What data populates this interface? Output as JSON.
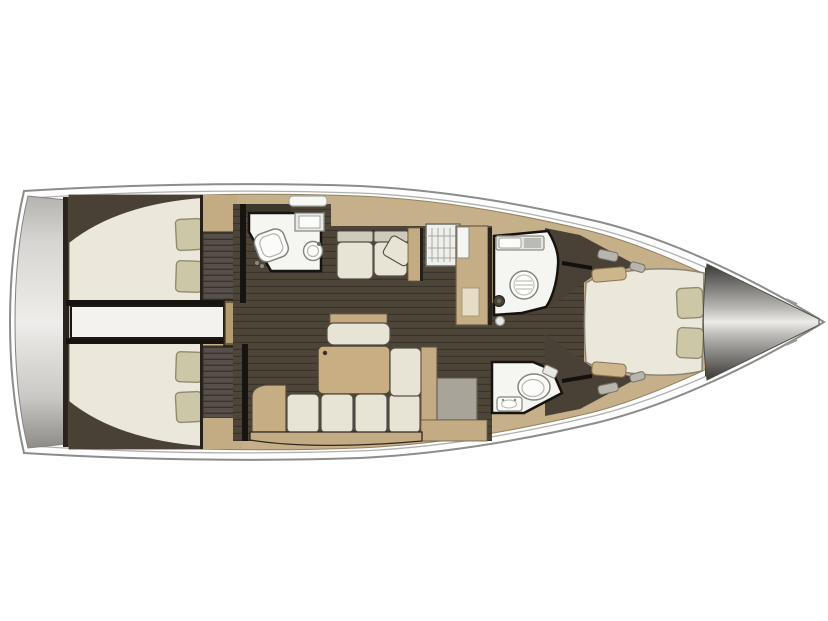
{
  "scene": {
    "type": "yacht-interior-floorplan",
    "orientation": "bow-right",
    "background": "#ffffff"
  },
  "colors": {
    "hull_fill": "#fdfdfd",
    "hull_stroke": "#8c8c8a",
    "inner_line": "#b0b0ae",
    "deck_wood": "#c6b08a",
    "wood_trim": "#c3ac84",
    "wood_dark": "#6b5a40",
    "floor_dark": "#4e4539",
    "floor_line": "#3a332b",
    "wall_dark": "#17130e",
    "divider_dark": "#2a241c",
    "cabin_shadow": "#4a4136",
    "bed_cream": "#ebe8db",
    "cushion_cream": "#e8e4d5",
    "cushion_outline": "#544f48",
    "pillow_khaki": "#cbc7a7",
    "pillow_outline": "#908c6d",
    "backrest_gray": "#cfcabb",
    "room_white": "#f5f5f2",
    "fixture_stroke": "#85857f",
    "counter_gray": "#a9a49a",
    "wardrobe_dark": "#57504a",
    "wardrobe_line": "#39332b",
    "table_wood": "#c9ae83",
    "ladder_wood": "#c9b284",
    "ladder_base": "#6e5b3f",
    "stove_white": "#efefec",
    "engine_white": "#f3f2ee"
  },
  "areas": [
    {
      "id": "swim-platform"
    },
    {
      "id": "aft-cabin-port",
      "features": [
        "double-berth",
        "two-pillows",
        "wardrobe"
      ]
    },
    {
      "id": "aft-cabin-starboard",
      "features": [
        "double-berth",
        "two-pillows",
        "wardrobe"
      ]
    },
    {
      "id": "engine-compartment"
    },
    {
      "id": "companionway-ladder",
      "steps": 4
    },
    {
      "id": "aft-head",
      "features": [
        "toilet",
        "sink",
        "counter"
      ]
    },
    {
      "id": "saloon",
      "features": [
        "settee-2-seats",
        "sofa-4-cushions",
        "table",
        "center-bench"
      ]
    },
    {
      "id": "galley",
      "features": [
        "stove-grid",
        "sink",
        "counter"
      ]
    },
    {
      "id": "shower-room",
      "features": [
        "shower",
        "sink-counter"
      ]
    },
    {
      "id": "toilet-room",
      "features": [
        "toilet",
        "sink"
      ]
    },
    {
      "id": "forward-cabin",
      "features": [
        "island-berth",
        "two-pillows",
        "side-shelves",
        "deck-hatches"
      ]
    },
    {
      "id": "anchor-locker"
    }
  ]
}
